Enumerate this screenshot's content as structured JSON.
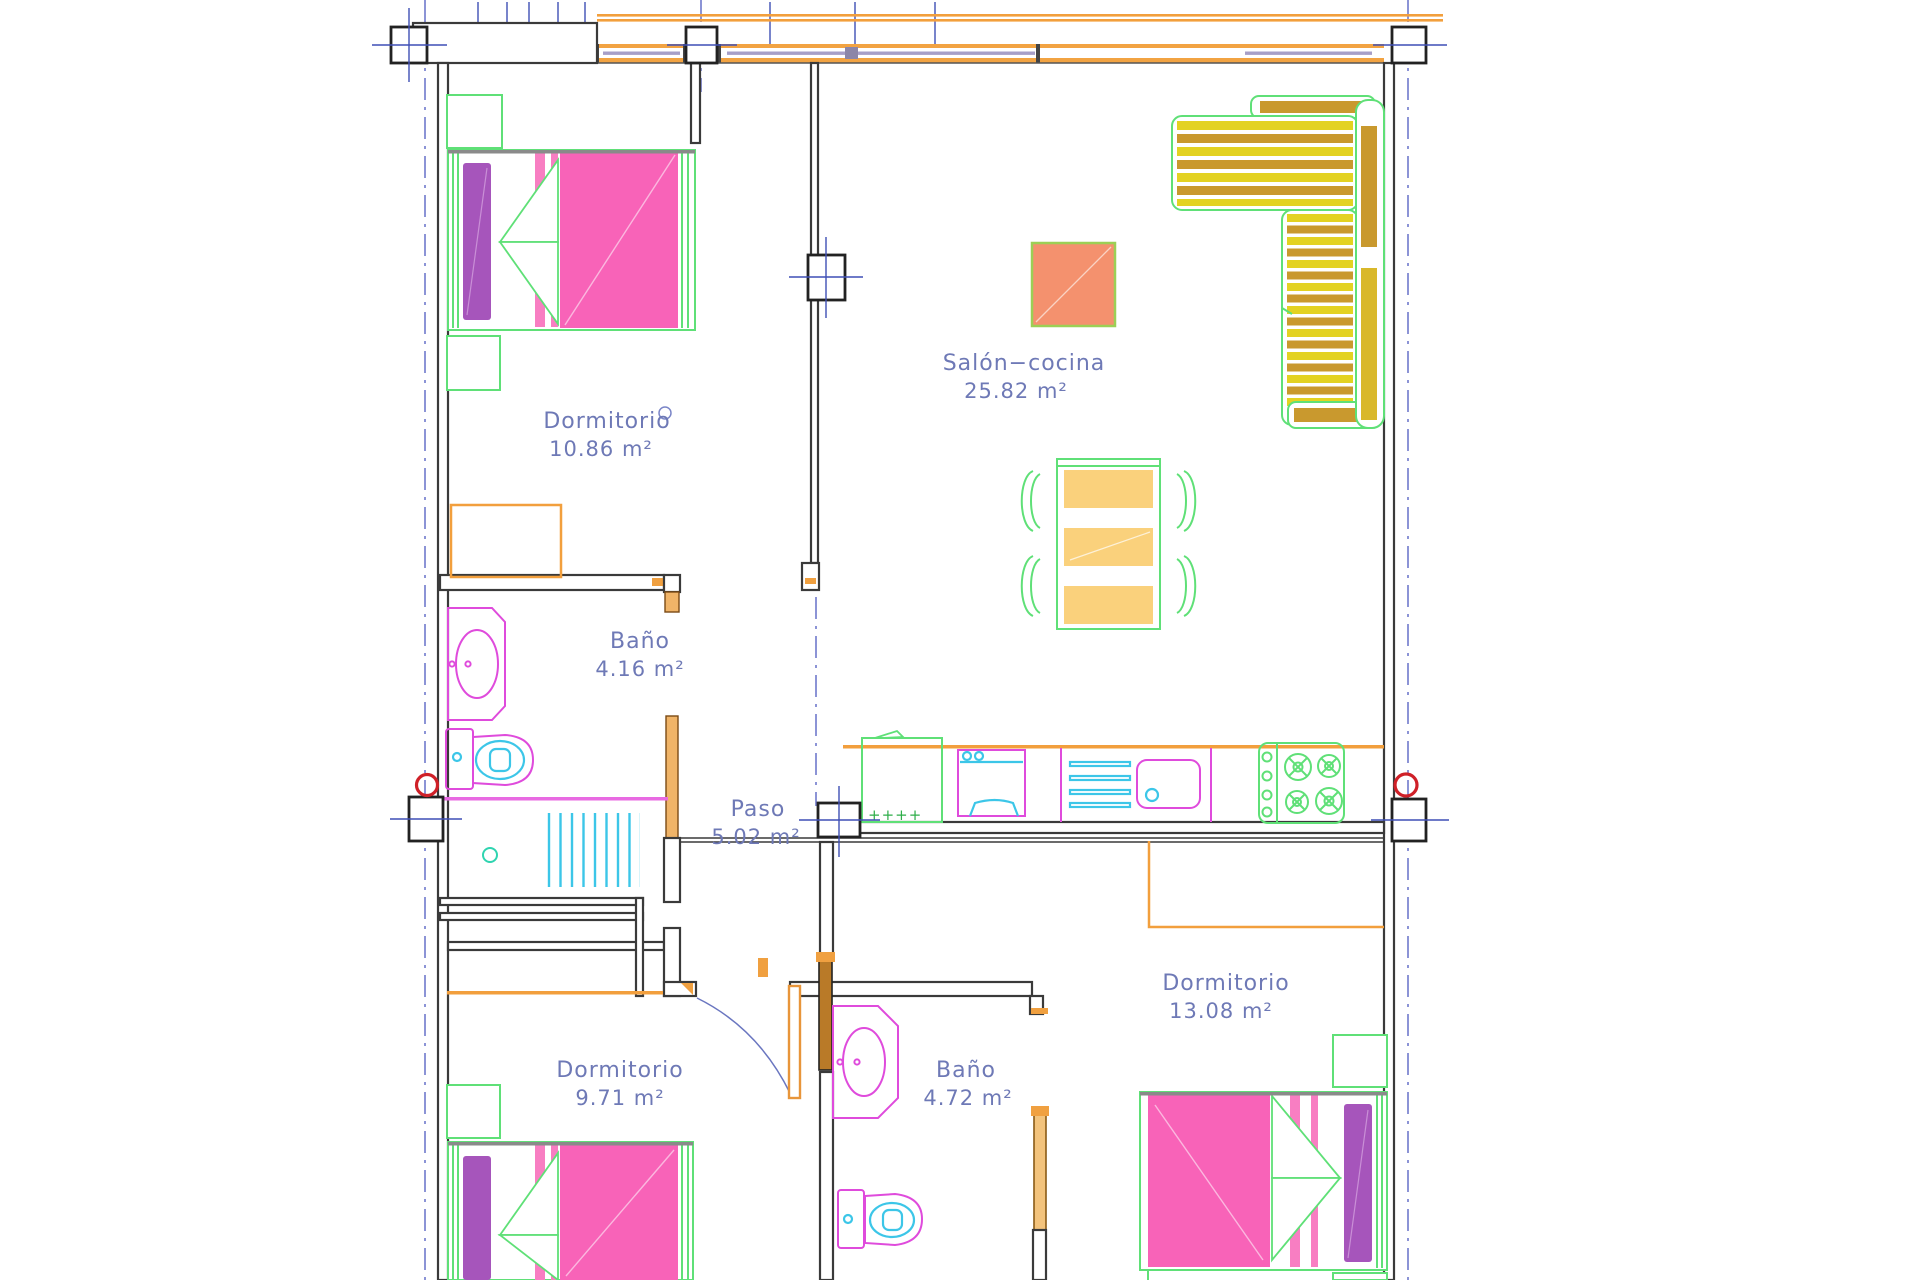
{
  "plan_title": "Planta de vivienda",
  "rooms": {
    "dormitorio1": {
      "name": "Dormitorio",
      "area": "10.86 m²"
    },
    "salon": {
      "name": "Salón−cocina",
      "area": "25.82 m²"
    },
    "bano1": {
      "name": "Baño",
      "area": "4.16 m²"
    },
    "paso": {
      "name": "Paso",
      "area": "5.02 m²"
    },
    "dormitorio2": {
      "name": "Dormitorio",
      "area": "13.08 m²"
    },
    "dormitorio3": {
      "name": "Dormitorio",
      "area": "9.71 m²"
    },
    "bano2": {
      "name": "Baño",
      "area": "4.72 m²"
    }
  },
  "palette": {
    "wall": "#3a3a3a",
    "axis_blue": "#7079cc",
    "cross_blue": "#3f4fb5",
    "label_blue": "#6e79b6",
    "furniture_green": "#5fe077",
    "bed_pink": "#f863b8",
    "pillow_purple": "#a655bb",
    "fixture_magenta": "#df4bdc",
    "water_cyan": "#3cc6e8",
    "carpentry_orange": "#f29f3d",
    "sofa_yellow": "#e3d222",
    "sofa_gold": "#c9992e",
    "table_amber": "#fad17c",
    "coffee_table_salmon": "#f4916e",
    "marker_red": "#cf2028"
  }
}
